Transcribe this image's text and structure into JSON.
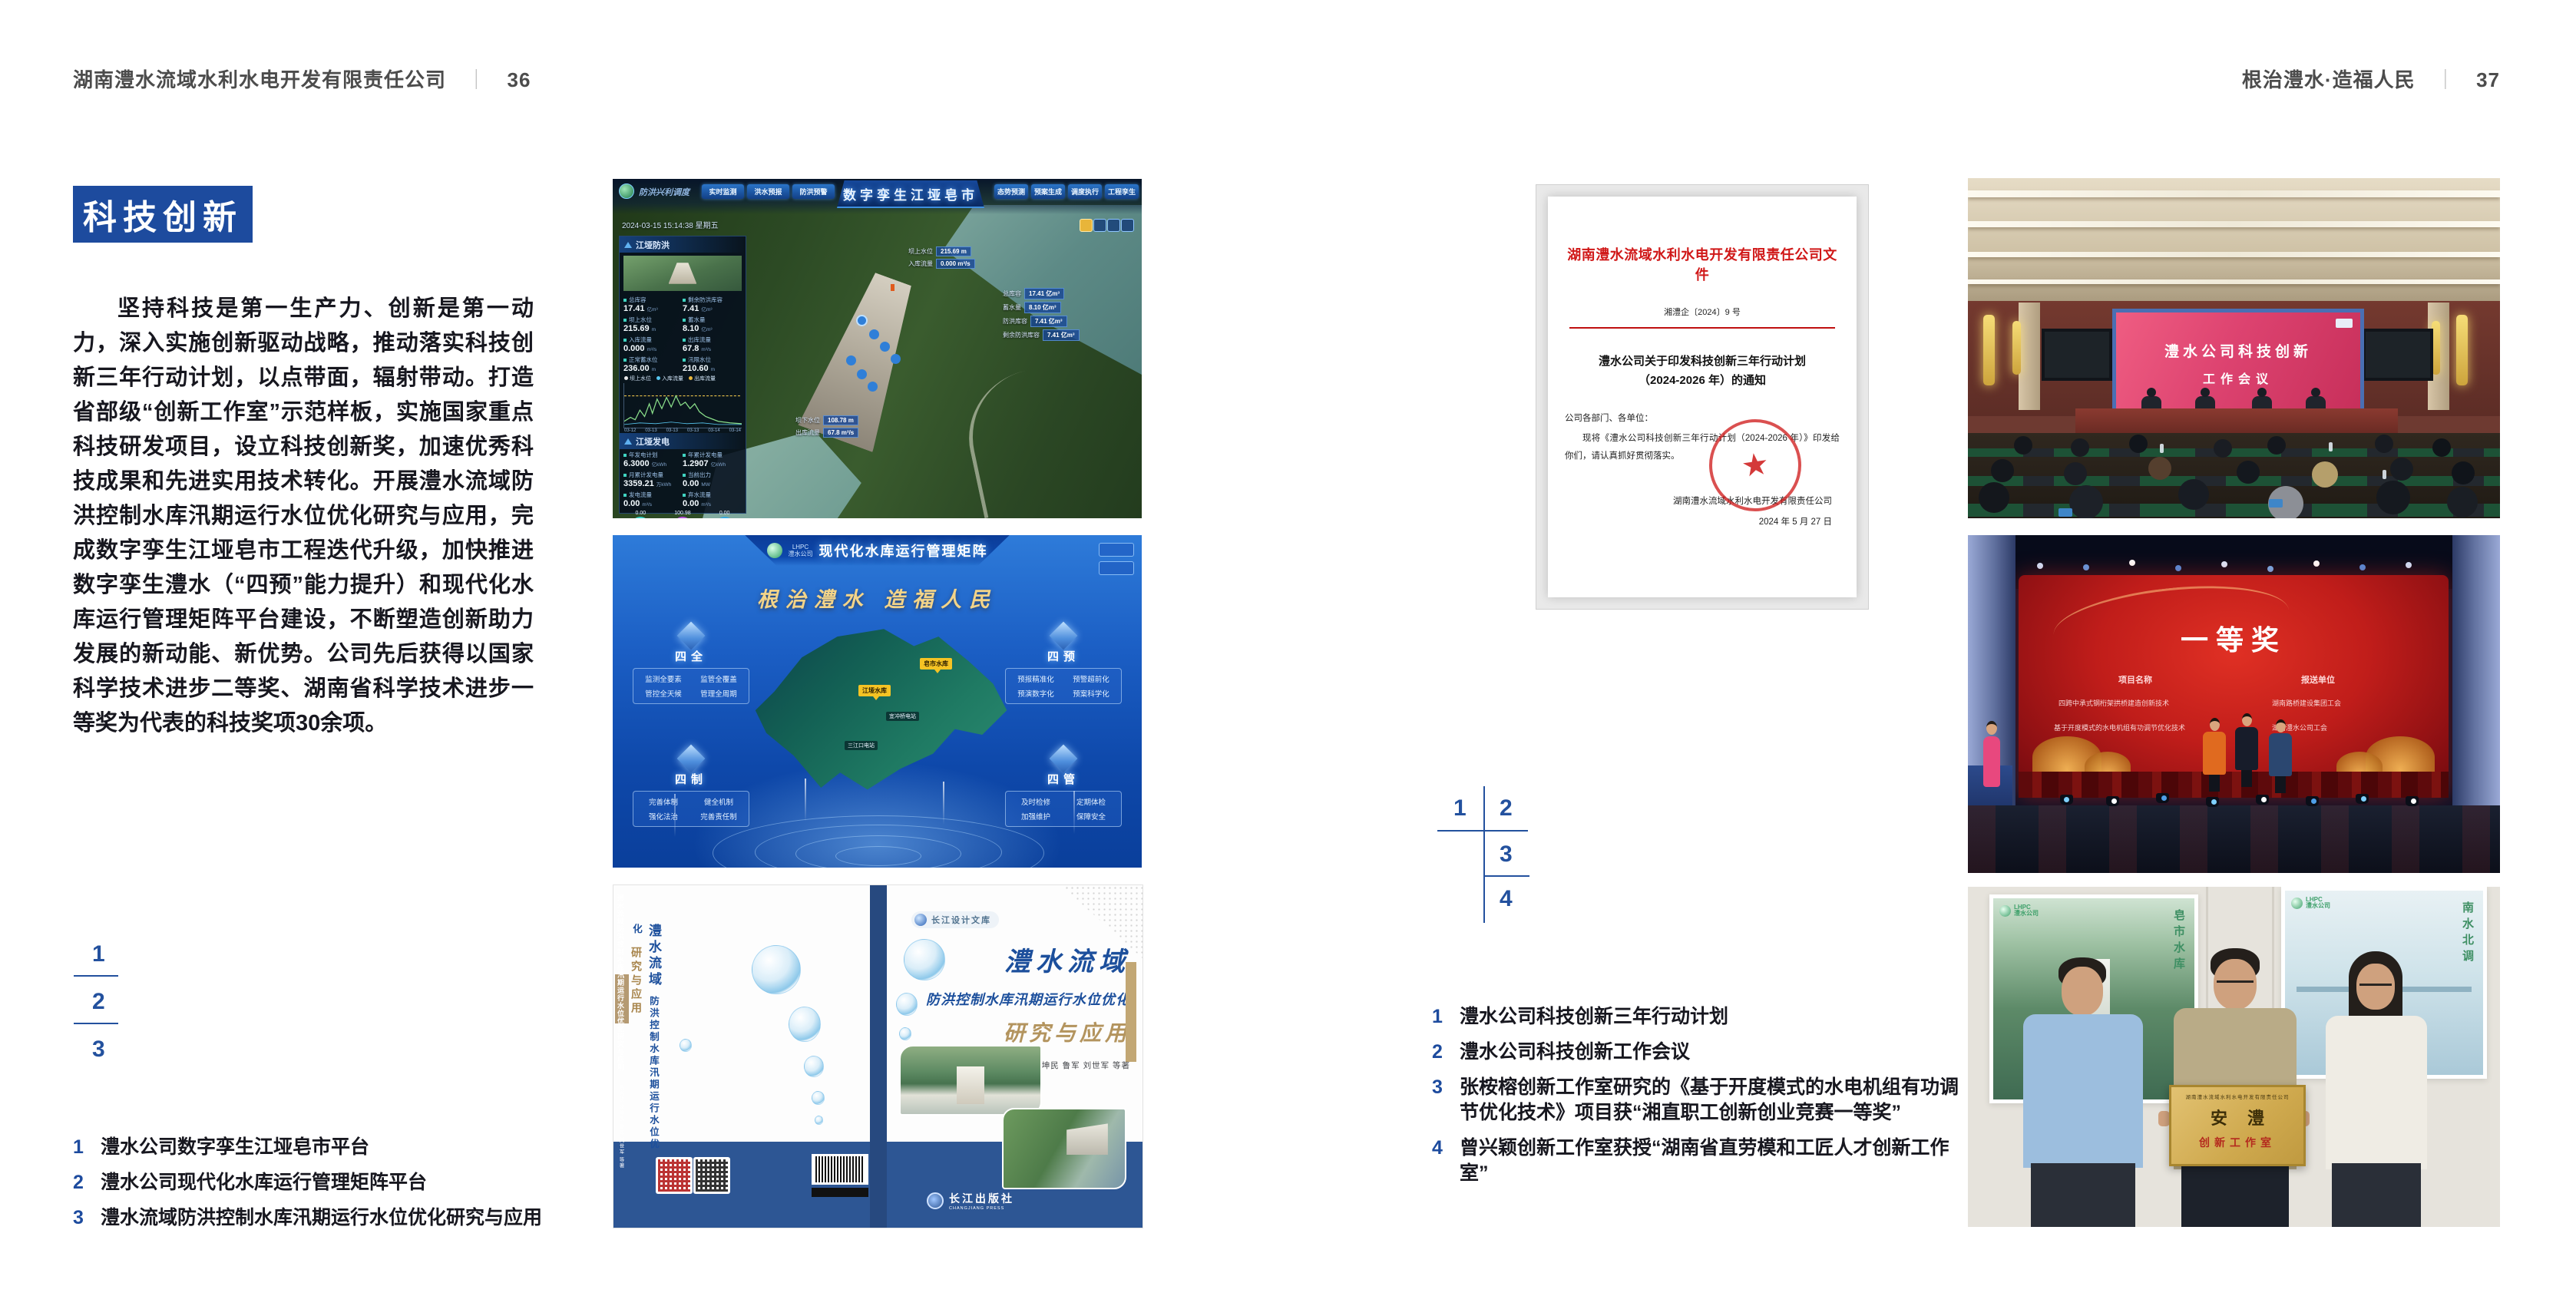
{
  "left_page": {
    "header_company": "湖南澧水流域水利水电开发有限责任公司",
    "header_sep": "｜",
    "header_page": "36",
    "badge": "科技创新",
    "paragraph": "坚持科技是第一生产力、创新是第一动力，深入实施创新驱动战略，推动落实科技创新三年行动计划，以点带面，辐射带动。打造省部级“创新工作室”示范样板，实施国家重点科技研发项目，设立科技创新奖，加速优秀科技成果和先进实用技术转化。开展澧水流域防洪控制水库汛期运行水位优化研究与应用，完成数字孪生江垭皂市工程迭代升级，加快推进数字孪生澧水（“四预”能力提升）和现代化水库运行管理矩阵平台建设，不断塑造创新助力发展的新动能、新优势。公司先后获得以国家科学技术进步二等奖、湖南省科学技术进步一等奖为代表的科技奖项30余项。",
    "fig_markers": [
      "1",
      "2",
      "3"
    ],
    "captions": [
      {
        "no": "1",
        "text": "澧水公司数字孪生江垭皂市平台"
      },
      {
        "no": "2",
        "text": "澧水公司现代化水库运行管理矩阵平台"
      },
      {
        "no": "3",
        "text": "澧水流域防洪控制水库汛期运行水位优化研究与应用"
      }
    ]
  },
  "right_page": {
    "header_title": "根治澧水·造福人民",
    "header_sep": "｜",
    "header_page": "37",
    "fig_markers": [
      "1",
      "2",
      "3",
      "4"
    ],
    "captions": [
      {
        "no": "1",
        "text": "澧水公司科技创新三年行动计划"
      },
      {
        "no": "2",
        "text": "澧水公司科技创新工作会议"
      },
      {
        "no": "3",
        "text": "张桉榕创新工作室研究的《基于开度模式的水电机组有功调节优化技术》项目获“湘直职工创新创业竞赛一等奖”"
      },
      {
        "no": "4",
        "text": "曾兴颖创新工作室获授“湖南省直劳模和工匠人才创新工作室”"
      }
    ]
  },
  "twin": {
    "title": "数字孪生江垭皂市",
    "module_label": "防洪兴利调度",
    "tabs_left": [
      "实时监测",
      "洪水预报",
      "防洪预警"
    ],
    "tabs_right": [
      "态势预测",
      "预案生成",
      "调度执行",
      "工程孪生"
    ],
    "datetime": "2024-03-15 15:14:38 星期五",
    "panel_flood_title": "江垭防洪",
    "stats": [
      {
        "label": "总库容",
        "value": "17.41",
        "unit": "亿m³"
      },
      {
        "label": "剩余防洪库容",
        "value": "7.41",
        "unit": "亿m³"
      },
      {
        "label": "坝上水位",
        "value": "215.69",
        "unit": "m"
      },
      {
        "label": "蓄水量",
        "value": "8.10",
        "unit": "亿m³"
      },
      {
        "label": "入库流量",
        "value": "0.000",
        "unit": "m³/s"
      },
      {
        "label": "出库流量",
        "value": "67.8",
        "unit": "m³/s"
      },
      {
        "label": "正常蓄水位",
        "value": "236.00",
        "unit": "m"
      },
      {
        "label": "汛限水位",
        "value": "210.60",
        "unit": "m"
      }
    ],
    "legend": [
      "坝上水位",
      "入库流量",
      "出库流量"
    ],
    "x_ticks": [
      "03-12",
      "03-13",
      "03-13",
      "03-13",
      "03-14",
      "03-14"
    ],
    "panel_gen_title": "江垭发电",
    "gen_stats": [
      {
        "label": "年发电计划",
        "value": "6.3000",
        "unit": "亿kWh"
      },
      {
        "label": "年累计发电量",
        "value": "1.2907",
        "unit": "亿kWh"
      },
      {
        "label": "月累计发电量",
        "value": "3359.21",
        "unit": "万kWh"
      },
      {
        "label": "当前出力",
        "value": "0.00",
        "unit": "MW"
      },
      {
        "label": "发电流量",
        "value": "0.00",
        "unit": "m³/s"
      },
      {
        "label": "弃水流量",
        "value": "0.00",
        "unit": "m³/s"
      }
    ],
    "units_row": [
      "0.00",
      "100.98",
      "0.00"
    ],
    "unit_labels": [
      "1号机",
      "2号机",
      "3号机"
    ],
    "callout_up": [
      {
        "label": "坝上水位",
        "value": "215.69 m"
      },
      {
        "label": "入库流量",
        "value": "0.000 m³/s"
      }
    ],
    "callout_right": [
      {
        "label": "总库容",
        "value": "17.41 亿m³"
      },
      {
        "label": "蓄水量",
        "value": "8.10 亿m³"
      },
      {
        "label": "防洪库容",
        "value": "7.41 亿m³"
      },
      {
        "label": "剩余防洪库容",
        "value": "7.41 亿m³"
      }
    ],
    "callout_down": [
      {
        "label": "坝下水位",
        "value": "108.78 m"
      },
      {
        "label": "出库流量",
        "value": "67.8 m³/s"
      }
    ]
  },
  "matrix": {
    "logo_abbr": "LHPC",
    "logo_name": "澧水公司",
    "title": "现代化水库运行管理矩阵",
    "slogan": "根治澧水  造福人民",
    "panels": [
      {
        "name": "四全",
        "items": [
          "监测全要素",
          "监管全覆盖",
          "管控全天候",
          "管理全周期"
        ]
      },
      {
        "name": "四预",
        "items": [
          "预报精准化",
          "预警超前化",
          "预演数字化",
          "预案科学化"
        ]
      },
      {
        "name": "四制",
        "items": [
          "完善体制",
          "健全机制",
          "强化法治",
          "完善责任制"
        ]
      },
      {
        "name": "四管",
        "items": [
          "及时检修",
          "定期体检",
          "加强维护",
          "保障安全"
        ]
      }
    ],
    "pins": [
      "皂市水库",
      "江垭水库"
    ],
    "pins_small": [
      "宜冲桥电站",
      "三江口电站"
    ]
  },
  "book": {
    "brand": "长江设计文库",
    "title1": "澧水流域",
    "title2": "防洪控制水库汛期运行水位优化",
    "title3": "研究与应用",
    "authors": "洪兴骏  沈坤民  鲁军  刘世军  等著",
    "publisher": "长江出版社",
    "publisher_en": "CHANGJIANG PRESS",
    "spine_title": "澧水流域防洪控制水库汛期运行水位优化研究与应用",
    "spine_authors": "洪兴骏  沈坤民  鲁军  刘世军  等著",
    "back_title1": "澧水流域",
    "back_title2": "防洪控制水库汛期运行水位优化",
    "back_title3": "研究与应用"
  },
  "doc": {
    "header": "湖南澧水流域水利水电开发有限责任公司文件",
    "doc_no": "湘澧企〔2024〕9 号",
    "title_line1": "澧水公司关于印发科技创新三年行动计划",
    "title_line2": "（2024-2026 年）的通知",
    "salutation": "公司各部门、各单位：",
    "body": "现将《澧水公司科技创新三年行动计划（2024-2026 年）》印发给你们，请认真抓好贯彻落实。",
    "sign_org": "湖南澧水流域水利水电开发有限责任公司",
    "sign_date": "2024 年 5 月 27 日",
    "seal_star": "★"
  },
  "meeting": {
    "screen_line1": "澧水公司科技创新",
    "screen_line2": "工作会议"
  },
  "award": {
    "title": "一等奖",
    "col1_header": "项目名称",
    "col2_header": "报送单位",
    "rows": [
      {
        "project": "四跨中承式钢桁架拱桥建造创新技术",
        "org": "湖南路桥建设集团工会"
      },
      {
        "project": "基于开度模式的水电机组有功调节优化技术",
        "org": "湖南澧水公司工会"
      }
    ]
  },
  "plaque": {
    "logo_abbr": "LHPC",
    "logo_name": "澧水公司",
    "poster_left_text": "皂市水库",
    "poster_right_text": "南水北调",
    "header": "湖南澧水流域水利水电开发有限责任公司",
    "title": "安澧",
    "subtitle": "创新工作室"
  }
}
